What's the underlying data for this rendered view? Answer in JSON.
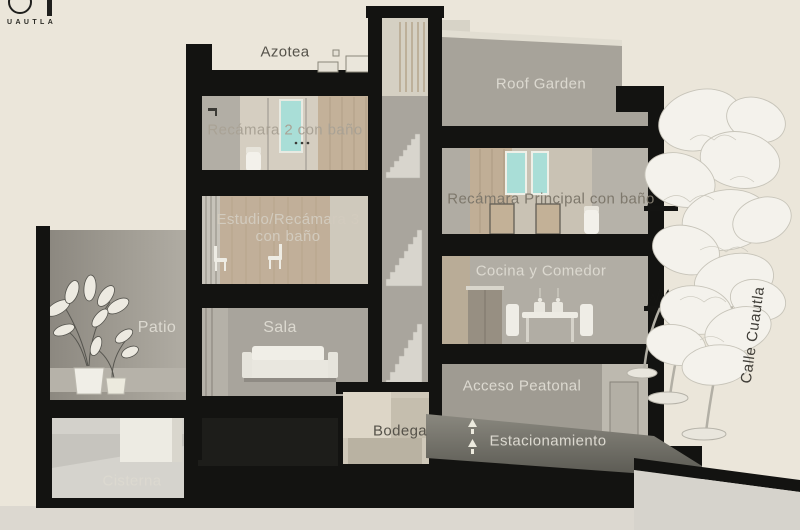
{
  "page": {
    "background": "#ebe6da"
  },
  "logo": {
    "mark_letters": "OT",
    "subtext": "UAUTLA"
  },
  "labels": {
    "azotea": "Azotea",
    "recamara2": "Recámara 2 con baño",
    "estudio_line1": "Estudio/Recámara 3",
    "estudio_line2": "con baño",
    "patio": "Patio",
    "sala": "Sala",
    "cisterna": "Cisterna",
    "bodega": "Bodega",
    "roof_garden": "Roof Garden",
    "recamara_principal": "Recámara Principal con baño",
    "cocina_comedor": "Cocina y Comedor",
    "acceso_peatonal": "Acceso Peatonal",
    "estacionamiento": "Estacionamiento",
    "calle": "Calle Cuautla"
  },
  "colors": {
    "background": "#ebe6da",
    "structure_black": "#131311",
    "wall_gray": "#a8a49b",
    "wall_beige": "#d5cec1",
    "wood_tan": "#c1af99",
    "window_teal": "#a9ded7",
    "label_light": "#dcd9d0",
    "label_dark": "#55524a",
    "ramp_gray": "#6b6a63",
    "street_gray": "#d6d3cc"
  }
}
